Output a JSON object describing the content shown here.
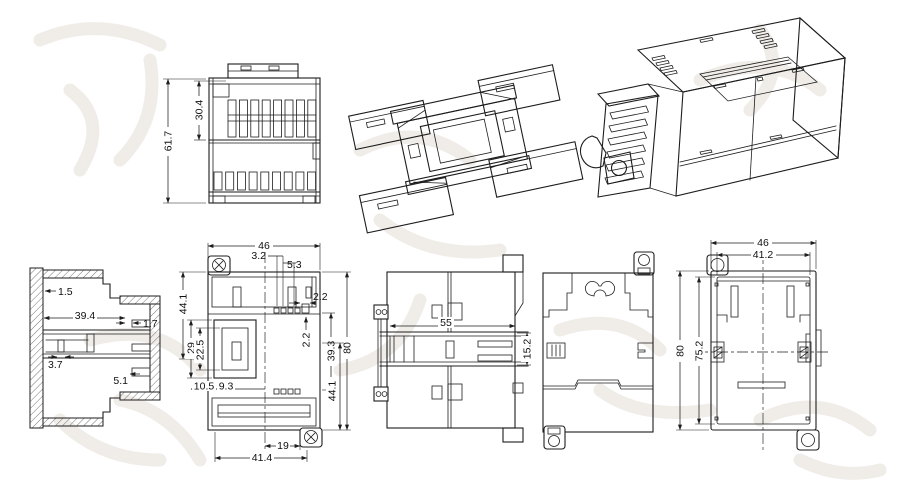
{
  "drawing": {
    "background_color": "#ffffff",
    "line_color": "#1d1d1d",
    "watermark_color": "#f0ede9",
    "description": "Multi-view technical drawing of a DIN-rail mounted electronic enclosure"
  },
  "views": {
    "end_elevation": {
      "dims": {
        "overall_height": "61.7",
        "upper_height": "30.4"
      }
    },
    "bottom_isometric": {},
    "assembled_isometric": {},
    "cross_section": {
      "dims": {
        "wall_thickness": "1.5",
        "inner_width": "39.4",
        "rib_width": "1.7",
        "latch_width": "3.7",
        "step_depth": "5.1"
      }
    },
    "rear_view": {
      "dims": {
        "overall_width": "46",
        "slot_offset_a": "3.2",
        "slot_offset_b": "5.3",
        "tab_gap_h": "2.2",
        "tab_gap_v": "2.2",
        "upper_height": "44.1",
        "latch_height": "29",
        "latch_inner_height": "22.5",
        "lower_inner_height": "39.3",
        "overall_height": "80",
        "lower_height": "44.1",
        "latch_width_a": "10.5",
        "latch_width_b": "9.3",
        "lug_offset": "19",
        "base_width": "41.4"
      }
    },
    "side_profile": {
      "dims": {
        "body_depth": "55",
        "rail_channel_height": "15.2"
      }
    },
    "front_cover": {},
    "open_front": {
      "dims": {
        "overall_width": "46",
        "inner_width": "41.2",
        "overall_height": "80",
        "inner_height": "75.2"
      }
    }
  }
}
